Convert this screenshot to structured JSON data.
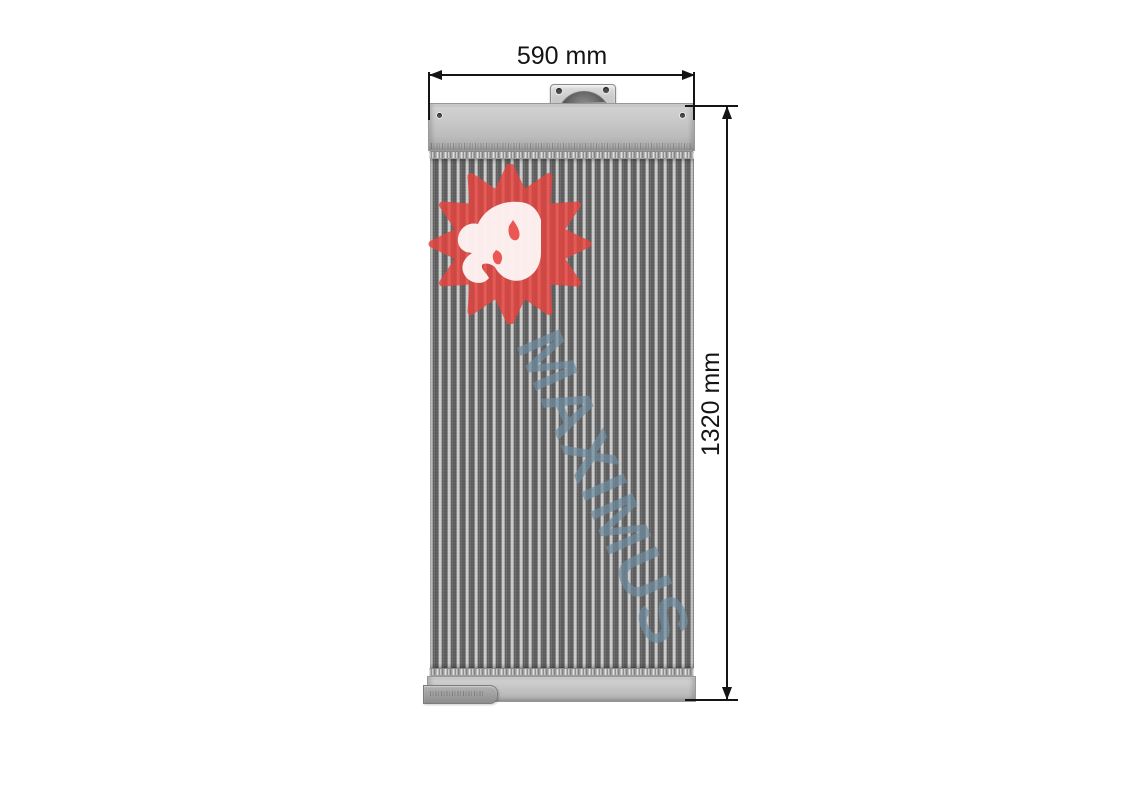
{
  "figure": {
    "watermark_text": "MAXIMUS"
  },
  "dimensions": {
    "width_label": "590 mm",
    "height_label": "1320 mm"
  },
  "icons": {
    "logo": "maximus-lion-logo",
    "arrows": [
      "arrow-left-icon",
      "arrow-right-icon",
      "arrow-up-icon",
      "arrow-down-icon"
    ]
  },
  "colors": {
    "logo_red": "#e8433e",
    "watermark_blue": "#6f8ca0",
    "dimension_ink": "#141414",
    "metal_light": "#cfcfcf",
    "metal_shadow": "#9d9d9d",
    "fin_dark": "#555555",
    "background": "#ffffff"
  }
}
